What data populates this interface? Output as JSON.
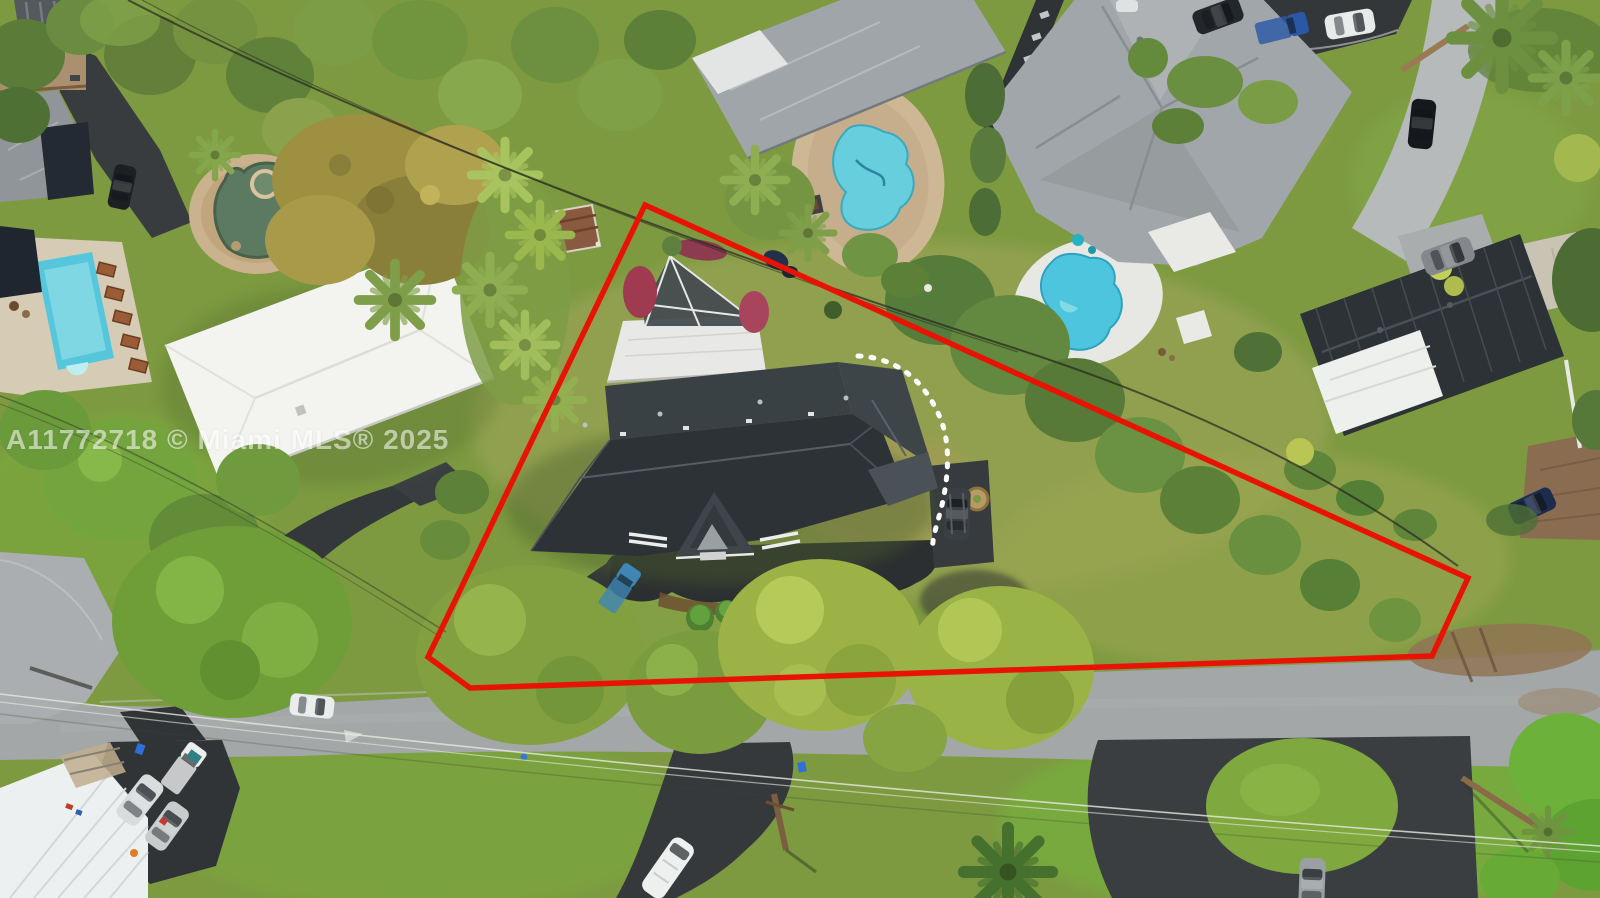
{
  "watermark": {
    "text": "A11772718 © Miami MLS® 2025",
    "color": "#ffffff"
  },
  "overlay": {
    "boundary_points": "645,205 1468,578 1432,656 470,688 428,657",
    "dashed_arc_path": "M 858 356 C 906 358 930 392 941 420 C 951 446 948 478 942 505 C 937 526 931 540 933 552"
  },
  "palette": {
    "wm": "#ffffff",
    "boundary": "#e81205",
    "dash": "#ffffff",
    "grass": "#7d9a40",
    "road": "#a3a7a8",
    "asphalt": "#33373a",
    "roofdark": "#2d3236",
    "roofgray": "#9fa5a8",
    "roofwhite": "#f1f2f0",
    "poolcyan": "#55c6dc",
    "pondgreen": "#5c7a61",
    "decktan": "#cbb28e"
  },
  "scene": {
    "type": "aerial-drone-photo",
    "objects": [
      "red-property-boundary",
      "dashed-white-arc",
      "mls-watermark",
      "subject-house-roof",
      "screened-pool-enclosure",
      "flat-roof-addition",
      "front-driveway-apron",
      "parked-dark-suv",
      "parked-blue-pickup",
      "neighbor-house-white-roof",
      "neighbor-house-gray-roof",
      "neighbor-big-house",
      "neighbor-house-charcoal-roof",
      "bottom-left-metal-roof",
      "top-left-house",
      "rect-swimming-pool",
      "kidney-pool-north",
      "kidney-pool-east",
      "stone-pond-pool",
      "street",
      "side-street-corner",
      "cul-de-sac-parking",
      "south-driveways",
      "white-van",
      "gray-sedan",
      "parked-cars-cluster",
      "cul-de-sac-cars",
      "power-lines",
      "utility-pole",
      "tree-canopies",
      "palm-trees",
      "hedges",
      "dirt-patch"
    ]
  }
}
